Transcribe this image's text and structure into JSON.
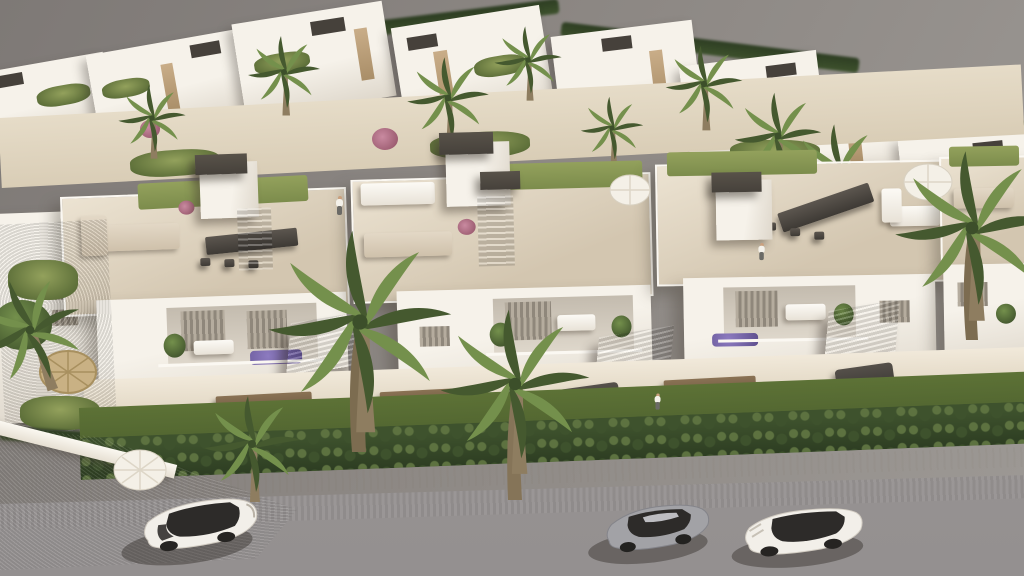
{
  "scene": {
    "description": "Aerial 3D architectural rendering of a modern white Mediterranean residential complex with rooftop terraces, furnished balconies, palm trees, hedged front gardens and a gray street with three parked cars",
    "setting": "overcast gray backdrop, sunlight from upper right casting shadows to lower left",
    "colors": {
      "sky_dark": "#7e7976",
      "sky_mid": "#8d8884",
      "sky_light": "#9d9995",
      "white_sun": "#f6f2ea",
      "white_shade": "#ded7cb",
      "shade_deep": "#c3bbae",
      "terrace": "#d3c6b0",
      "terrace_light": "#ece3d2",
      "stone": "#c9ad88",
      "stone_dark": "#a98e68",
      "pergola": "#46413b",
      "louver_a": "#b5ac9e",
      "louver_b": "#8f877b",
      "grass_roof": "#93a15c",
      "grass_ground": "#4c5f2e",
      "hedge": "#3e522d",
      "hedge_dark": "#2d3d22",
      "hedge_light": "#5d7240",
      "palm_light": "#74904c",
      "palm_dark": "#45592f",
      "trunk": "#8e7d60",
      "sidewalk": "#e5dcc6",
      "road": "#9b9795",
      "road_light": "#aaa5a0",
      "sofa_beige": "#cfc1ab",
      "furniture_dark": "#4a4540",
      "flower_purple": "#8d7bc0",
      "flower_pink": "#c98aa0",
      "car_white": "#f2efe9",
      "car_silver": "#a2a2a6",
      "glass_dark": "#2d2b29",
      "shadow": "#342f28"
    },
    "inventory": {
      "parked_cars": 3,
      "car_types": [
        "white SUV",
        "silver sports coupe",
        "white sedan"
      ],
      "building_modules_front_row": 4,
      "rooftop_terraces": 4,
      "people_visible": 3,
      "foreground_palm_trees": 4
    },
    "labels": {
      "stage": "aerial render of residential development",
      "sky": "gray backdrop",
      "far_villas": "background villa cluster",
      "garden_band": "landscaped walkway between rows",
      "main_row": "front apartment row with roof terraces",
      "roof_terrace": "furnished roof terrace",
      "stair_tower": "stair tower with dark pergola cap",
      "stone_canopy": "stone-clad balcony canopy",
      "balcony": "recessed balcony with plants",
      "ground_terrace": "ground-floor patio with dining set",
      "lawn": "front garden lawn",
      "hedge": "boundary hedge row",
      "sidewalk": "light stone sidewalk",
      "road": "asphalt street",
      "driveway": "concrete driveway corner",
      "car_suv": "white SUV parked on street",
      "car_coupe": "silver sports coupe parked on street",
      "car_sedan": "white sedan parked on street",
      "palm": "palm tree",
      "parasol_white": "white parasol",
      "parasol_straw": "straw parasol",
      "person": "person"
    }
  }
}
